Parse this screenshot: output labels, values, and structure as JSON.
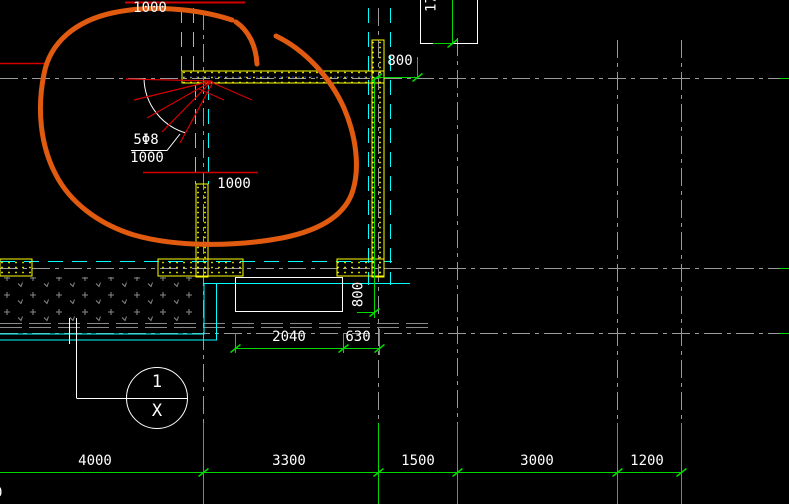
{
  "drawing": {
    "type": "structural-plan-detail",
    "annotations": {
      "top_spacing": "1000",
      "rebar_callout": "5Φ8",
      "rebar_spacing": "1000",
      "mid_spacing": "1000",
      "top_right_partial_dim": "17",
      "offset_800_top": "800",
      "pit_depth_800": "800",
      "pit_width": "2040",
      "pit_offset": "630",
      "left_edge_partial_dim": "0",
      "callout": {
        "detail_number": "1",
        "sheet_ref": "X"
      },
      "bottom_dims": [
        "4000",
        "3300",
        "1500",
        "3000",
        "1200"
      ]
    },
    "colors": {
      "dimension_green": "#00d900",
      "wall_yellow": "#ffff00",
      "centerline_cyan": "#00ffff",
      "markup_orange": "#e05a10",
      "rebar_red": "#d40000",
      "grid_gray": "#9a9a9a",
      "text_white": "#ffffff",
      "background": "#000000"
    }
  }
}
